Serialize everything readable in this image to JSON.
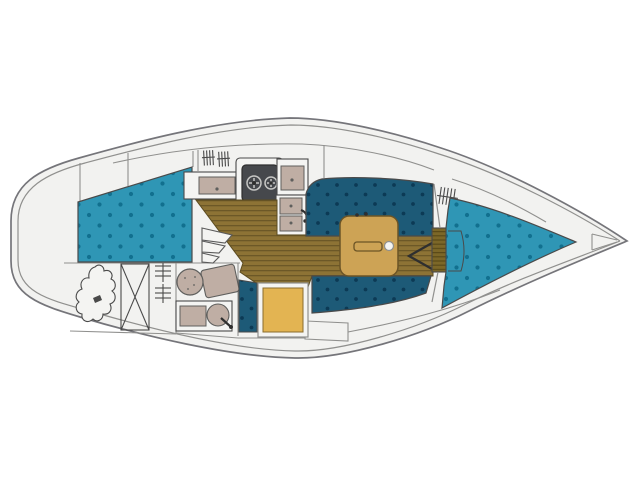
{
  "meta": {
    "description": "Sailboat interior deck plan, top view, bow pointing right"
  },
  "colors": {
    "page_bg": "#ffffff",
    "hull_fill": "#f2f2f0",
    "hull_stroke": "#75757a",
    "line_dark": "#4a4a4a",
    "line_light": "#90908e",
    "berth_teal": "#2f96b5",
    "berth_dot": "#11708f",
    "settee_teal": "#1d5a77",
    "settee_dot": "#0c3a55",
    "sole_wood": "#8d7335",
    "sole_stripe": "#6c5827",
    "step_wood": "#7c6728",
    "step_stripe": "#5a4a18",
    "table_wood": "#cda355",
    "table_stroke": "#6b5426",
    "seat_yellow": "#e3b452",
    "seat_yellow_stroke": "#8a6d2e",
    "fixture_taupe": "#bfaea4",
    "fixture_stroke": "#5f5f5d",
    "stove_dark": "#46484c",
    "burner_light": "#c6c6c4",
    "white": "#f4f4f2",
    "mark_dark": "#2f2f2f"
  },
  "areas": [
    {
      "id": "aft-cabin-berth",
      "label": "aft cabin berth cushion"
    },
    {
      "id": "stowed-gear-sketch",
      "label": "stowed gear sketch in aft locker"
    },
    {
      "id": "crossed-locker",
      "label": "cockpit stowage locker"
    },
    {
      "id": "aft-louver-symbol",
      "label": "louvered vent panel"
    },
    {
      "id": "head-toilet",
      "label": "marine toilet"
    },
    {
      "id": "head-sink",
      "label": "head washbasin with faucet"
    },
    {
      "id": "companionway-steps",
      "label": "companionway steps"
    },
    {
      "id": "companionway-hatch-slats",
      "label": "companionway hatch slats"
    },
    {
      "id": "galley-counter",
      "label": "galley counter"
    },
    {
      "id": "galley-stove",
      "label": "two-burner stove"
    },
    {
      "id": "galley-sinks",
      "label": "galley double sink with faucet"
    },
    {
      "id": "cabin-sole",
      "label": "planked cabin sole"
    },
    {
      "id": "quarter-berth",
      "label": "quarter berth cushion"
    },
    {
      "id": "nav-seat",
      "label": "chart table seat"
    },
    {
      "id": "port-settee",
      "label": "port saloon settee"
    },
    {
      "id": "starboard-settee",
      "label": "starboard saloon settee"
    },
    {
      "id": "saloon-table",
      "label": "saloon table"
    },
    {
      "id": "mast-post",
      "label": "mast compression post"
    },
    {
      "id": "bulkhead-louver",
      "label": "louvered forward bulkhead door"
    },
    {
      "id": "v-berth",
      "label": "V-berth cushion"
    },
    {
      "id": "v-berth-step",
      "label": "V-berth entry step"
    },
    {
      "id": "bow-locker",
      "label": "anchor locker at bow"
    }
  ],
  "galley": {
    "burner_count": 2,
    "sink_count": 2
  }
}
